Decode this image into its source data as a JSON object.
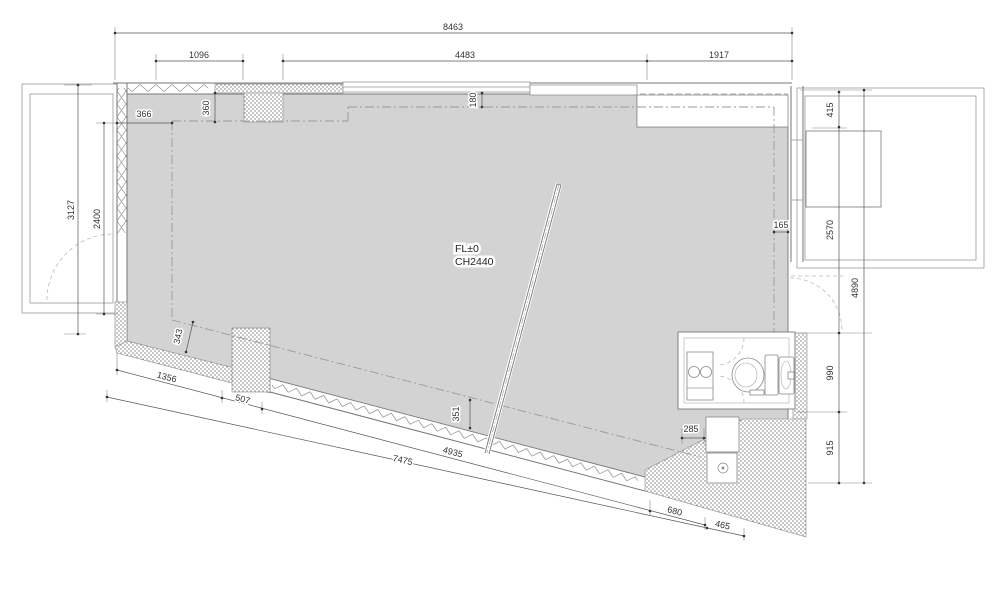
{
  "drawing": {
    "room": {
      "floor_level": "FL±0",
      "ceiling_height": "CH2440"
    },
    "dims": {
      "overall_width": "8463",
      "top_seg_1": "1096",
      "top_seg_2": "4483",
      "top_seg_3": "1917",
      "left_depth": "3127",
      "left_opening": "2400",
      "inset_left": "366",
      "inset_top_left": "360",
      "inset_top": "180",
      "inset_right": "165",
      "right_top": "415",
      "right_balcony": "2570",
      "right_total": "4890",
      "right_bath": "990",
      "right_kitchen": "915",
      "inset_bottom_left": "343",
      "inset_bottom": "351",
      "kitchen_front": "285",
      "bottom_seg_1": "1356",
      "bottom_seg_2": "507",
      "bottom_seg_3": "4935",
      "bottom_seg_4": "680",
      "bottom_total": "7475",
      "bottom_seg_5": "465"
    },
    "colors": {
      "floor_fill": "#d3d3d3",
      "line": "#777777",
      "dim_text": "#333333",
      "background": "#ffffff"
    }
  }
}
